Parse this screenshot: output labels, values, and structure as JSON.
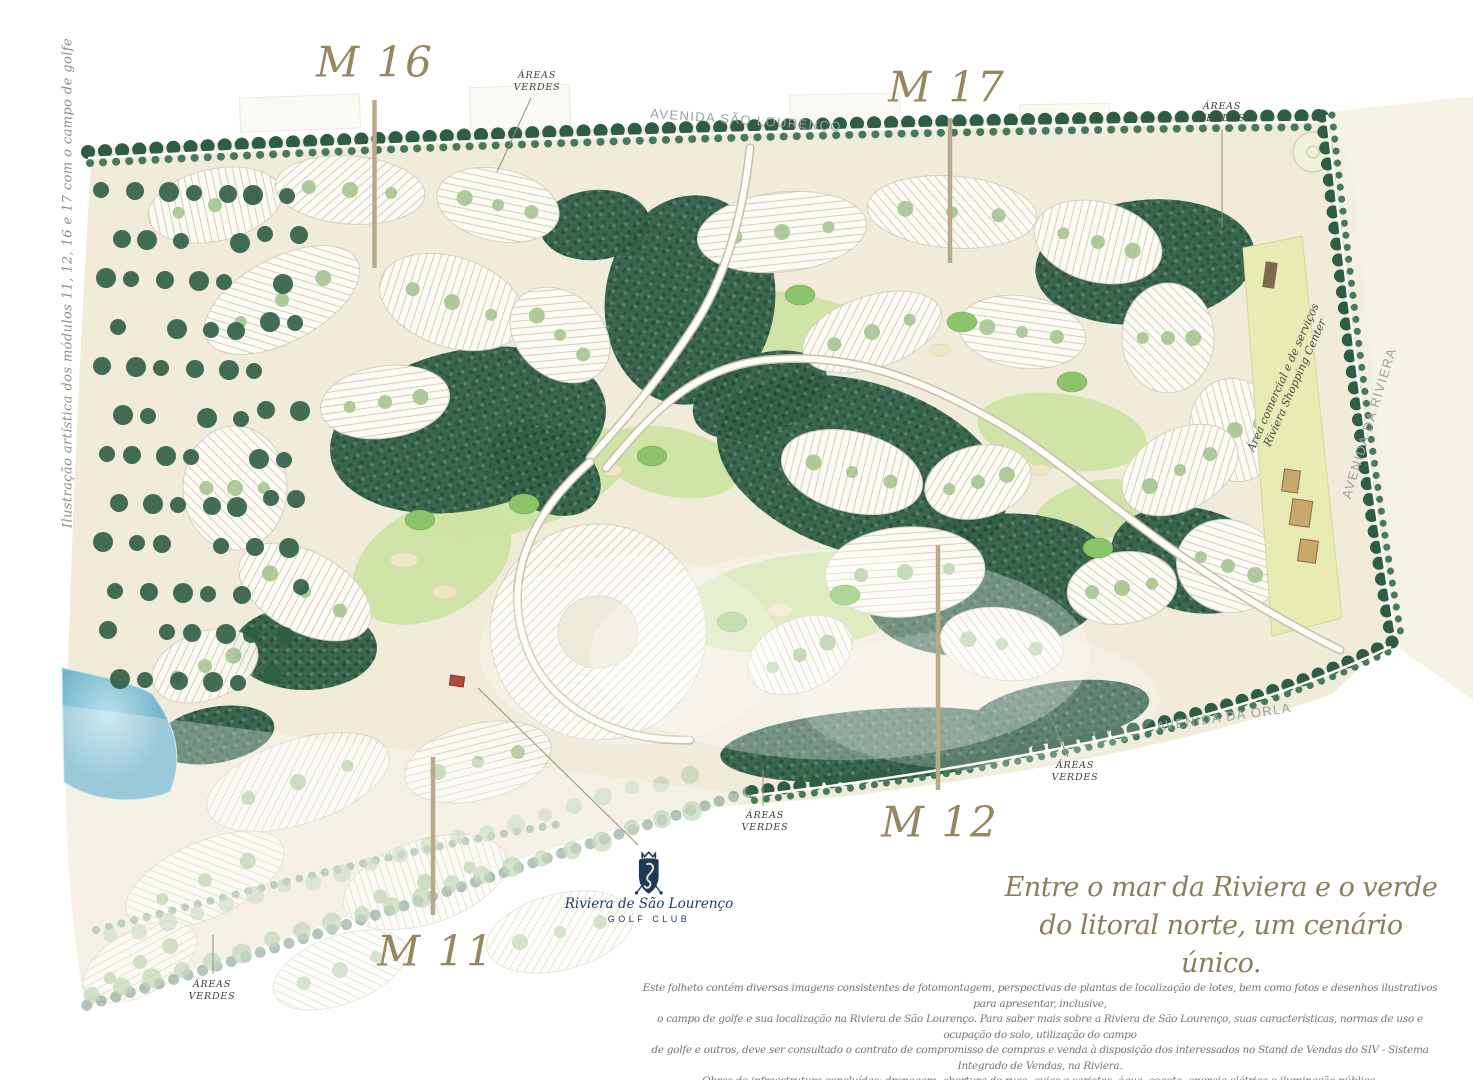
{
  "caption_left": "Ilustração artística dos módulos 11, 12, 16 e 17 com o campo de golfe",
  "modules": {
    "m16": "M 16",
    "m17": "M 17",
    "m12": "M 12",
    "m11": "M 11"
  },
  "avenues": {
    "sao_lourenco": "AVENIDA SÃO LOURENÇO",
    "riviera": "AVENIDA DA RIVIERA",
    "orla": "AVENIDA DA ORLA"
  },
  "green_label": {
    "line1": "ÁREAS",
    "line2": "VERDES"
  },
  "shopping": {
    "line1": "Área comercial e de serviços",
    "line2": "Riviera Shopping Center"
  },
  "logo": {
    "club_name": "Riviera de São Lourenço",
    "club_type": "GOLF CLUB"
  },
  "tagline": {
    "line1": "Entre o mar da Riviera e o verde",
    "line2": "do litoral norte, um cenário único."
  },
  "disclaimer": {
    "line1": "Este folheto contém diversas imagens consistentes de fotomontagem, perspectivas de plantas de localização de lotes, bem como fotos e desenhos ilustrativos para apresentar, inclusive,",
    "line2": "o campo de golfe e sua localização na Riviera de São Lourenço. Para saber mais sobre a Riviera de São Lourenço, suas características, normas de uso e ocupação do solo, utilização do campo",
    "line3": "de golfe e outros, deve ser consultado o contrato de compromisso de compras e venda à disposição dos interessados no Stand de Vendas do SIV - Sistema Integrado de Vendas, na Riviera.",
    "line4": "Obras de infraestrutura concluídas: drenagem, abertura de ruas, guias e sarjetas, água, esgoto, energia elétrica e iluminação pública."
  },
  "colors": {
    "module_label": "#97875f",
    "leader_line": "#b8a98c",
    "tagline_text": "#8a7f5c",
    "avenue_text": "#98a19f",
    "green_label_text": "#3f3f35",
    "caption_text": "#8d8d86",
    "logo_navy": "#1d3a5a",
    "map_cream": "#f1ecda",
    "forest_green": "#33614a",
    "fairway_green": "#cde3a2",
    "lake_blue": "#8cc6d8"
  }
}
